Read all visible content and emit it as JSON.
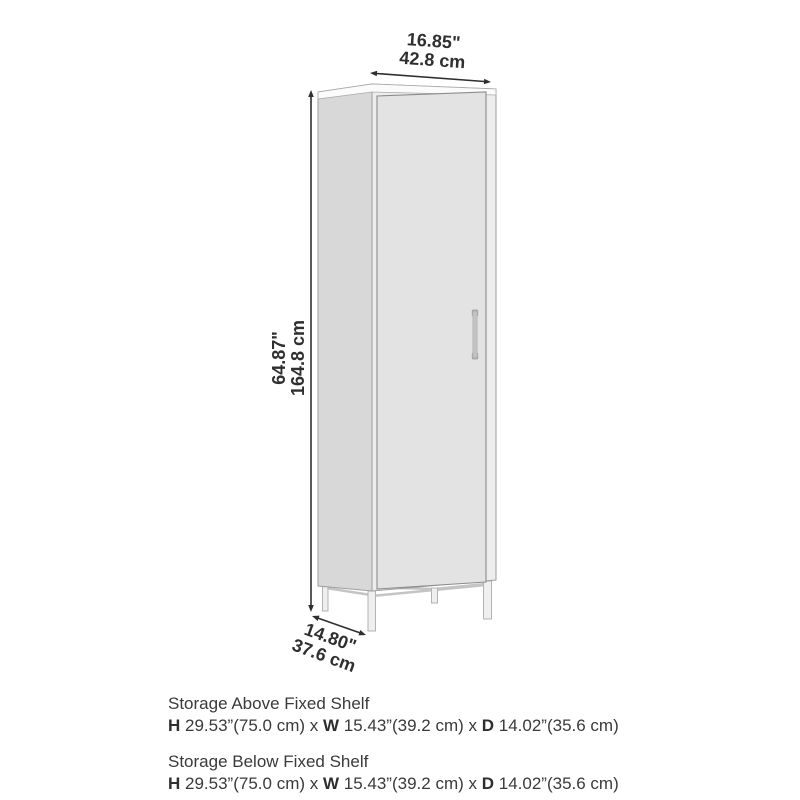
{
  "diagram": {
    "subject": "tall storage cabinet with door and metal leg base",
    "dimensions": {
      "width": {
        "inches": "16.85\"",
        "cm": "42.8 cm"
      },
      "height": {
        "inches": "64.87\"",
        "cm": "164.8 cm"
      },
      "depth": {
        "inches": "14.80\"",
        "cm": "37.6 cm"
      }
    }
  },
  "dim_labels": {
    "h": "H",
    "w": "W",
    "d": "D",
    "sep": "x"
  },
  "specs": [
    {
      "title": "Storage Above Fixed Shelf",
      "h": "29.53”(75.0 cm)",
      "w": "15.43”(39.2 cm)",
      "d": "14.02”(35.6 cm)"
    },
    {
      "title": "Storage Below Fixed Shelf",
      "h": "29.53”(75.0 cm)",
      "w": "15.43”(39.2 cm)",
      "d": "14.02”(35.6 cm)"
    }
  ],
  "colors": {
    "background": "#ffffff",
    "side_panel": "#d8d8d8",
    "front_panel": "#ededed",
    "door": "#e3e3e3",
    "top_board": "#fbfbfb",
    "outline": "#9e9e9e",
    "door_outline": "#8c8c8c",
    "handle": "#c2c2c2",
    "leg_fill": "#efefef",
    "leg_stroke": "#b3b3b3",
    "arrow": "#2f2f2f",
    "text": "#3a3a3a"
  }
}
